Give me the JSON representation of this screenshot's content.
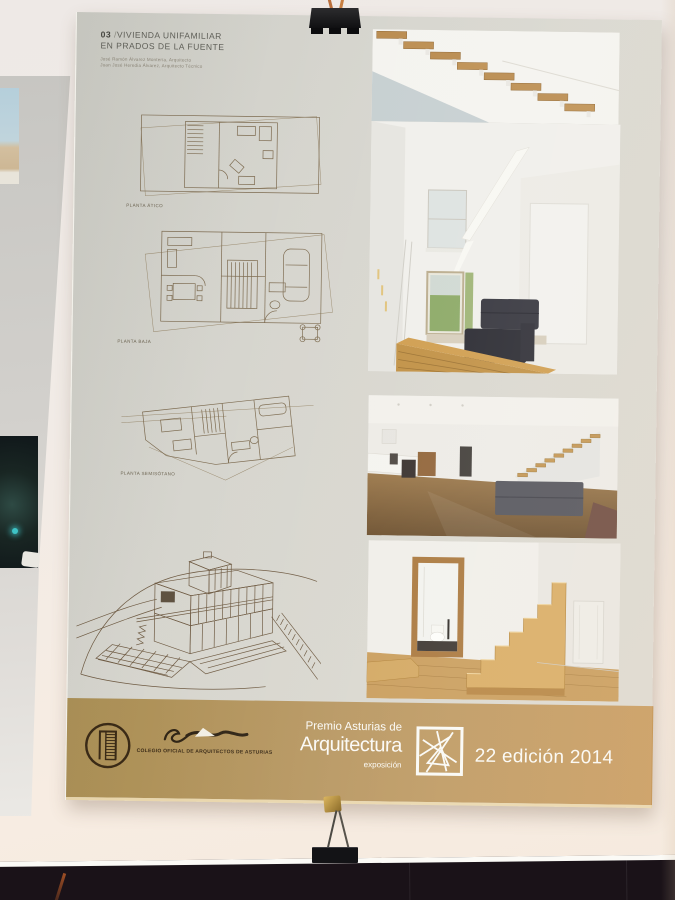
{
  "scene": {
    "wall_color": "#f2ece5",
    "bottom_poster_color": "#1a1218",
    "clip_color": "#141416"
  },
  "poster": {
    "bg_color": "#d6d5ce",
    "header": {
      "number": "03",
      "separator": "/",
      "title_line1": "VIVIENDA UNIFAMILIAR",
      "title_line2": "EN PRADOS DE LA FUENTE",
      "credit_line1": "José Ramón Álvarez Montería, Arquitecto",
      "credit_line2": "Juan José Heredia Álvarez, Arquitecto Técnico"
    },
    "plans": [
      {
        "label": "PLANTA ÁTICO"
      },
      {
        "label": "PLANTA BAJA"
      },
      {
        "label": "PLANTA SEMISÓTANO"
      }
    ],
    "banner": {
      "colegio_label": "COLEGIO OFICIAL DE ARQUITECTOS DE ASTURIAS",
      "premio_line1": "Premio Asturias de",
      "premio_line2": "Arquitectura",
      "premio_line3": "exposición",
      "edition": "22 edición 2014",
      "bg_left": "#ab9056",
      "bg_right": "#c89a5c",
      "text_color": "#fbfaf6",
      "logo_color": "#3a2a16"
    }
  }
}
